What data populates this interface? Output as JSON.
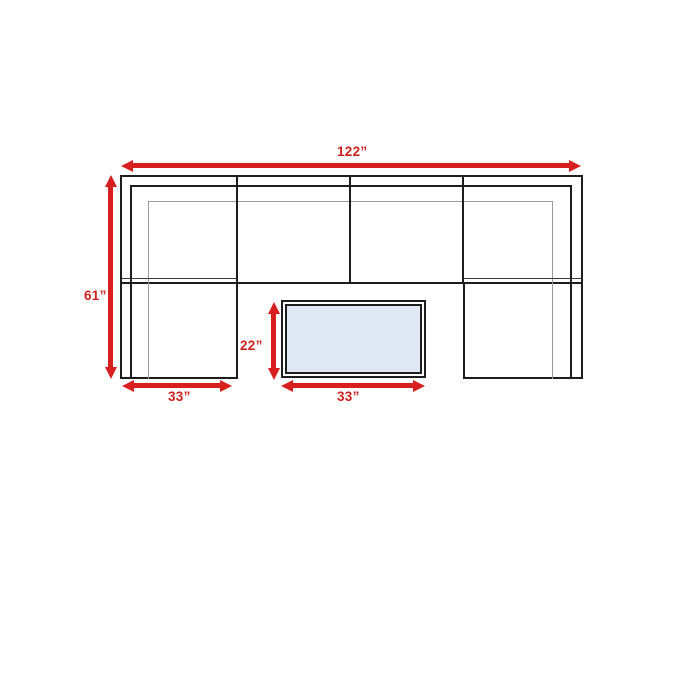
{
  "diagram": {
    "kind": "sectional-sofa-dimension-plan",
    "description": "Top-down dimension diagram of a U-shaped 6-piece sectional with a rectangular coffee table",
    "dimension_labels": {
      "overall_width": "122”",
      "overall_depth": "61”",
      "left_section_width": "33”",
      "coffee_table_depth": "22”",
      "coffee_table_width": "33”"
    },
    "colors": {
      "dimension_red": "#d81f1f",
      "label_red": "#cc2222",
      "outline_black": "#1d1d1d",
      "thin_line_gray": "#9a9a9a",
      "table_fill_blue": "#dfe9f5",
      "background": "#ffffff"
    }
  }
}
